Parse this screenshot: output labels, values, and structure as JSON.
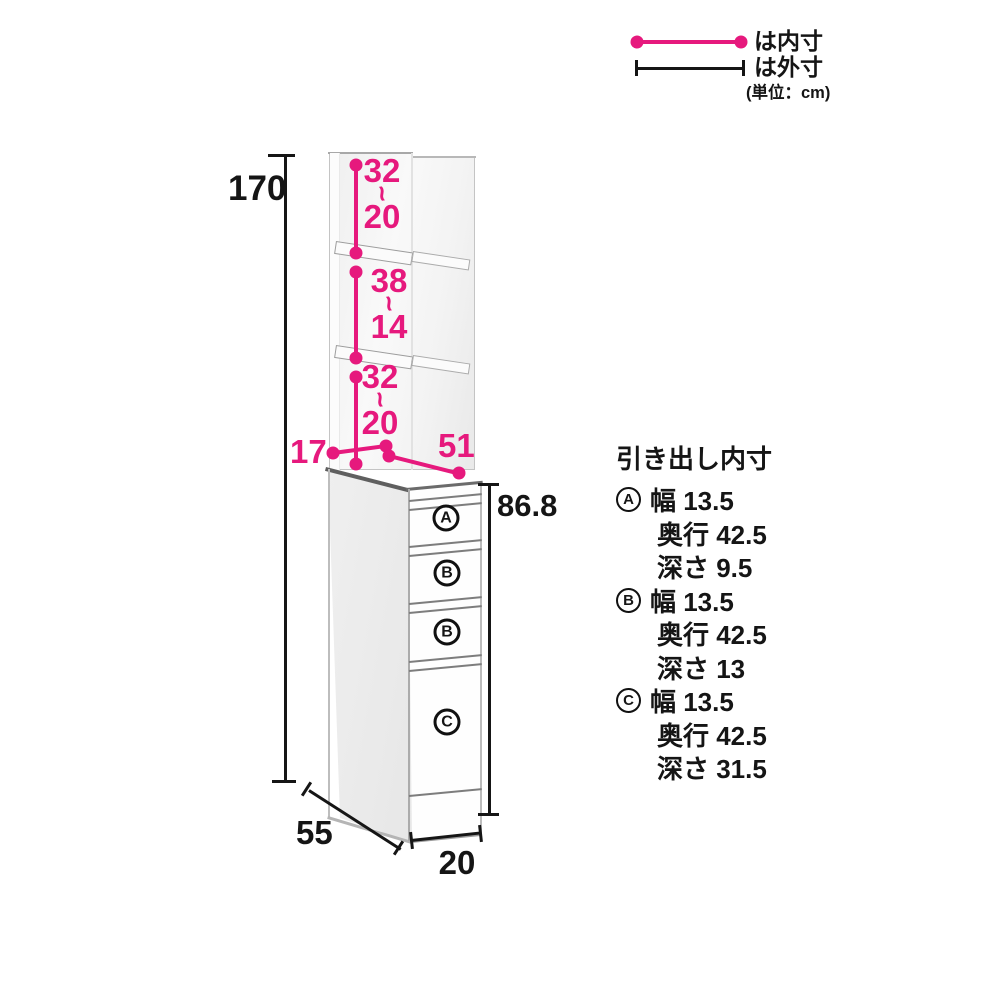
{
  "colors": {
    "pink": "#e6197d",
    "line": "#151515"
  },
  "legend": {
    "inner_label": "は内寸",
    "outer_label": "は外寸",
    "unit_note": "(単位：cm)"
  },
  "dims": {
    "total_height": "170",
    "cabinet_height": "86.8",
    "depth": "55",
    "width": "20",
    "upper_shelf_depth": "17",
    "counter_depth": "51",
    "tilde": "~",
    "sections": [
      {
        "max": "32",
        "min": "20"
      },
      {
        "max": "38",
        "min": "14"
      },
      {
        "max": "32",
        "min": "20"
      }
    ]
  },
  "drawers": {
    "front_labels": [
      "A",
      "B",
      "B",
      "C"
    ],
    "spec_title": "引き出し内寸",
    "specs": [
      {
        "label": "A",
        "width": "幅 13.5",
        "depth": "奥行 42.5",
        "height": "深さ 9.5"
      },
      {
        "label": "B",
        "width": "幅 13.5",
        "depth": "奥行 42.5",
        "height": "深さ 13"
      },
      {
        "label": "C",
        "width": "幅 13.5",
        "depth": "奥行 42.5",
        "height": "深さ 31.5"
      }
    ]
  }
}
